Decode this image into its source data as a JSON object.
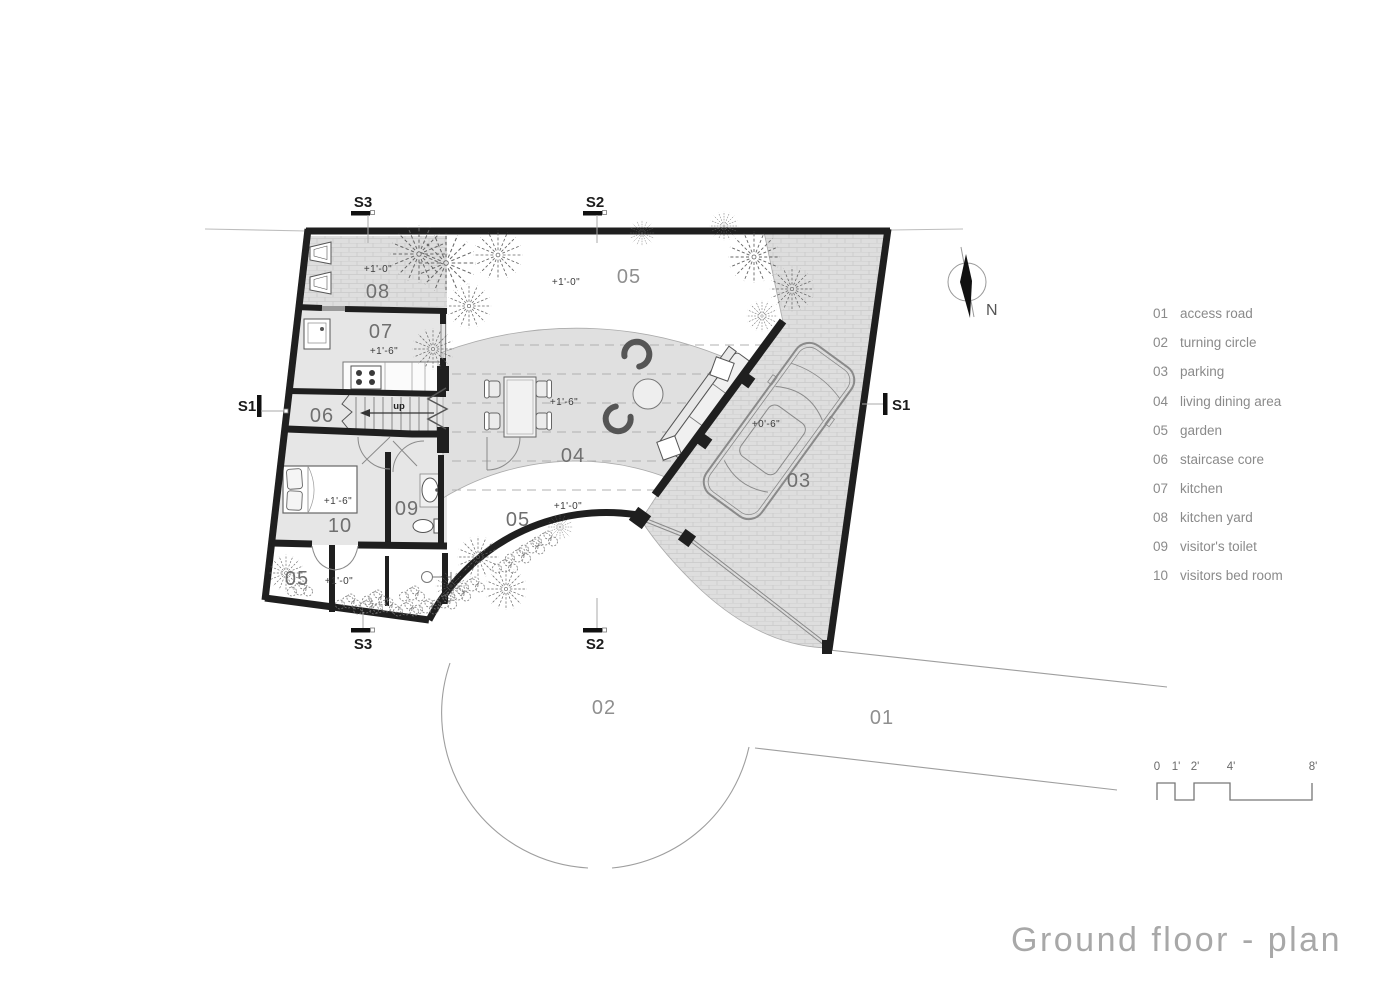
{
  "title": "Ground floor  - plan",
  "compass": {
    "label": "N"
  },
  "section_markers": {
    "s1": "S1",
    "s2": "S2",
    "s3": "S3"
  },
  "scale_bar": {
    "ticks": [
      "0",
      "1'",
      "2'",
      "4'",
      "8'"
    ]
  },
  "legend": {
    "items": [
      {
        "num": "01",
        "label": "access road"
      },
      {
        "num": "02",
        "label": "turning circle"
      },
      {
        "num": "03",
        "label": "parking"
      },
      {
        "num": "04",
        "label": "living dining area"
      },
      {
        "num": "05",
        "label": "garden"
      },
      {
        "num": "06",
        "label": "staircase core"
      },
      {
        "num": "07",
        "label": "kitchen"
      },
      {
        "num": "08",
        "label": "kitchen yard"
      },
      {
        "num": "09",
        "label": "visitor's toilet"
      },
      {
        "num": "10",
        "label": "visitors bed room"
      }
    ]
  },
  "plan": {
    "labels": {
      "r08": "08",
      "e08": "+1'-0\"",
      "r07": "07",
      "e07": "+1'-6\"",
      "r06": "06",
      "up": "up",
      "g05top": "05",
      "e05top": "+1'-0\"",
      "r04": "04",
      "e04": "+1'-6\"",
      "g05mid": "05",
      "e05mid": "+1'-0\"",
      "r03": "03",
      "e03": "+0'-6\"",
      "r09": "09",
      "r10": "10",
      "e10": "+1'-6\"",
      "g05bl": "05",
      "e05bl": "+1'-0\"",
      "r02": "02",
      "r01": "01"
    }
  },
  "colors": {
    "wall": "#1f1f1f",
    "floor_fill": "#e6e6e6",
    "living_band_fill": "#e0e0e0",
    "paver_fill": "#dedede",
    "thin_line": "#999999",
    "label_gray": "#6f6f6f",
    "title_gray": "#a8a8a8"
  }
}
